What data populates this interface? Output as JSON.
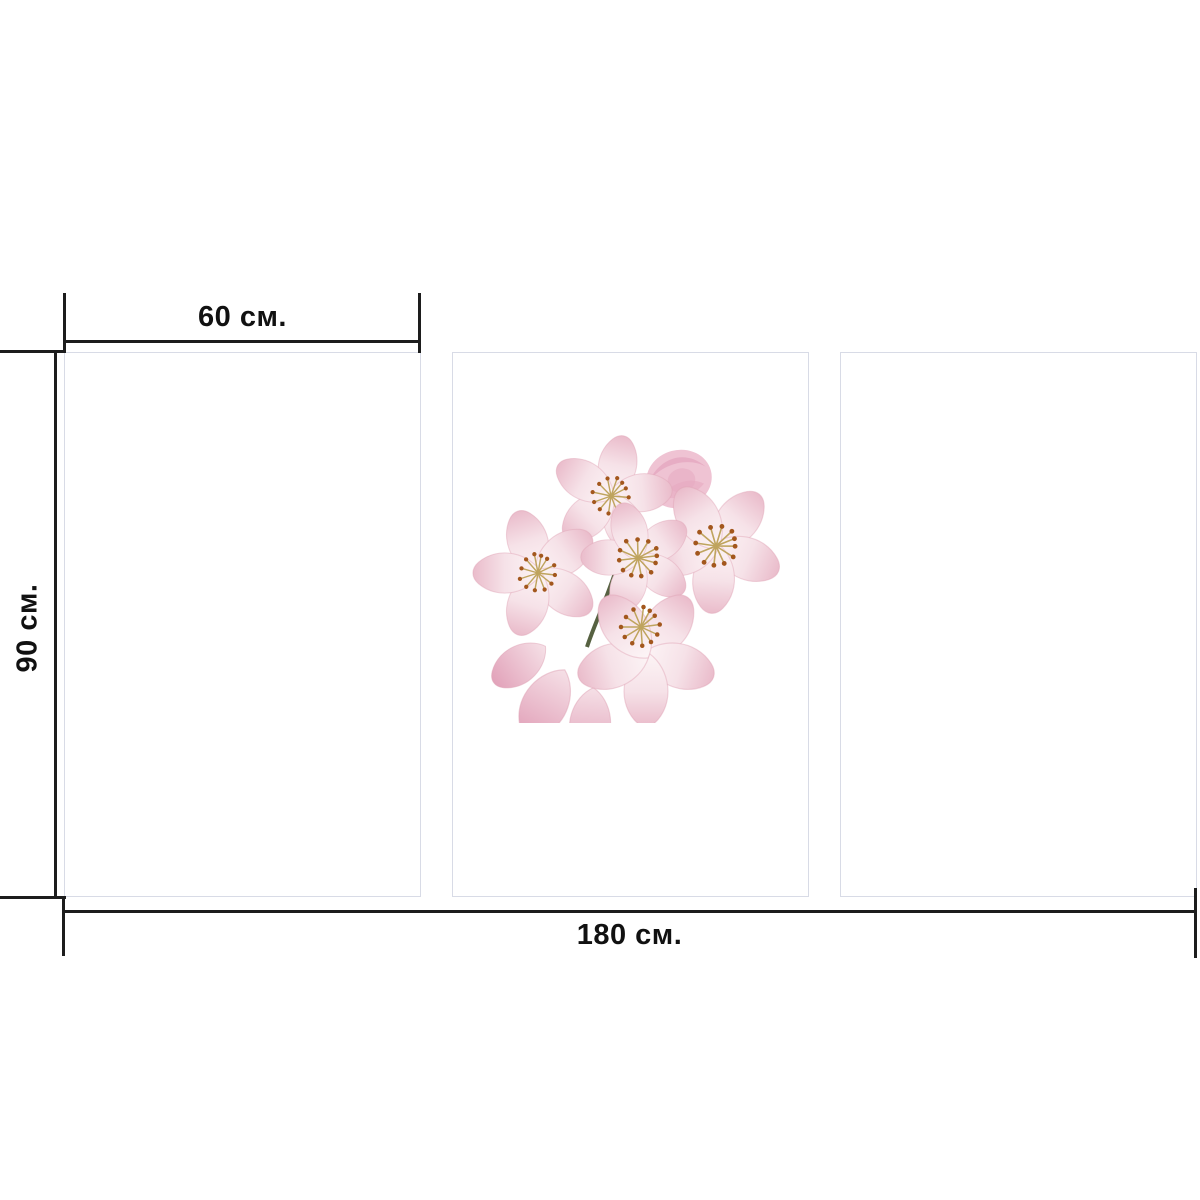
{
  "dimensions": {
    "panel_width_label": "60 см.",
    "height_label": "90 см.",
    "total_width_label": "180 см."
  },
  "panels": {
    "count": 3,
    "items": [
      {
        "id": "left",
        "content": "empty"
      },
      {
        "id": "center",
        "content": "cherry-blossom-photo"
      },
      {
        "id": "right",
        "content": "empty"
      }
    ]
  },
  "artwork": {
    "subject": "cherry blossom flower cluster",
    "blossoms": 5,
    "buds": 1
  },
  "colors": {
    "bg": "#ffffff",
    "line": "#1d1d1d",
    "text": "#111111",
    "panel-fill": "#ffffff",
    "panel-border": "#d8dbe6",
    "petal-light": "#fdf6f7",
    "petal-mid": "#f6e2e8",
    "petal-pink": "#eabccb",
    "petal-deep": "#e2a3ba",
    "petal-edge": "#dfa3b6",
    "bud-pink": "#efc3d3",
    "bud-deep": "#e5a8c0",
    "stamen": "#a3571d",
    "filament": "#bfa45e",
    "stem": "#44502c"
  }
}
